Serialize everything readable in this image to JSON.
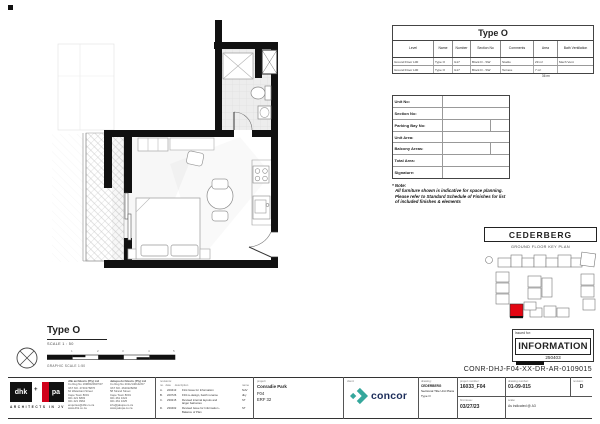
{
  "colors": {
    "accent_red": "#e30613",
    "concor_teal": "#35a79c",
    "concor_navy": "#1c2d5a",
    "wall": "#111111"
  },
  "unit_table": {
    "title": "Type O",
    "headers": [
      "Level",
      "Name",
      "Number",
      "Section No",
      "Comments",
      "Area",
      "Bath Ventilation"
    ],
    "rows": [
      [
        "Ground Floor L00",
        "Type O",
        "G17",
        "Block D - SW",
        "Studio",
        "29 m²",
        "Mech Vent"
      ],
      [
        "Ground Floor L00",
        "Type O",
        "G17",
        "Block D - SW",
        "Terrace",
        "7 m²",
        ""
      ]
    ],
    "total_area": "36 m²"
  },
  "info_form": {
    "labels": [
      "Unit No:",
      "Section No:",
      "Parking Bay No:",
      "Unit Area:",
      "Balcony Areas:",
      "Total Area:",
      "Signature:"
    ]
  },
  "note": {
    "title": "* Note:",
    "line1": "All furniture shown is indicative for space planning.",
    "line2": "Please refer to Standard Schedule of Finishes for list",
    "line3": "of included finishes & elements"
  },
  "key_plan": {
    "title": "CEDERBERG",
    "subtitle": "GROUND FLOOR KEY PLAN"
  },
  "stamp": {
    "label": "Issued for:",
    "value": "INFORMATION",
    "code": "250403"
  },
  "doc_number": "CONR-DHJ-F04-XX-DR-AR-0109015",
  "plan_title": {
    "title": "Type O",
    "scale": "SCALE 1 : 50",
    "graphic_scale": "GRAPHIC SCALE 1:50",
    "ticks": [
      "1",
      "2",
      "3",
      "4",
      "5"
    ]
  },
  "title_block": {
    "brand": {
      "logo1": "dhk",
      "logo2": "pa",
      "plus": "+",
      "tagline": "ARCHITECTS IN JV"
    },
    "firm1": {
      "lines": [
        "dhk architects (Pty) Ltd",
        "Co Reg No 1998/020907/07",
        "VAT NO. 4740176876",
        "",
        "62 Waterkant Street",
        "Cape Town 8001",
        "021 421 6803",
        "021 421 0964",
        "enquiries@dhk.co.za",
        "www.dhk.co.za"
      ]
    },
    "firm2": {
      "lines": [
        "Jakupa Architects (Pty) Ltd",
        "Co Reg No 2011/146142/07",
        "VAT NO. 4620228266",
        "",
        "58 Strand Street",
        "Cape Town 8001",
        "021 461 1624",
        "021 461 1625",
        "info@jakupa.co.za",
        "www.jakupa.co.za"
      ]
    },
    "revisions": {
      "header": "revisions:",
      "cols": [
        "no.",
        "date",
        "description",
        "name"
      ],
      "rows": [
        {
          "no": "A.",
          "date": "220413",
          "desc": "First Issue for Information",
          "desc2": "",
          "name": "NdV"
        },
        {
          "no": "B.",
          "date": "220726",
          "desc": "F04 re-design, batch rename",
          "desc2": "",
          "name": "dky"
        },
        {
          "no": "C.",
          "date": "230215",
          "desc": "Revised internal layouts and",
          "desc2": "larger balconies",
          "name": "ST"
        },
        {
          "no": "D.",
          "date": "230402",
          "desc": "Revised Issue for Information -",
          "desc2": "Balance of Plan",
          "name": "ST"
        }
      ]
    },
    "project": {
      "header": "project:",
      "line1": "Conradie Park",
      "line2": "F04",
      "line3": "ERF 32"
    },
    "client": {
      "header": "client:",
      "name": "concor"
    },
    "drawing": {
      "header": "drawing:",
      "line1": "CEDERBERG",
      "line2": "Sectional Title Unit Plans",
      "line3": "Type O"
    },
    "project_number": {
      "header": "project number:",
      "value": "16033_F04"
    },
    "drawing_number": {
      "header": "drawing number:",
      "value": "01-09-015"
    },
    "revision": {
      "header": "revision:",
      "value": "D"
    },
    "first_issue": {
      "header": "first issue:",
      "value": "03/27/23"
    },
    "scale": {
      "header": "scale:",
      "value": "As indicated @ A3"
    }
  }
}
